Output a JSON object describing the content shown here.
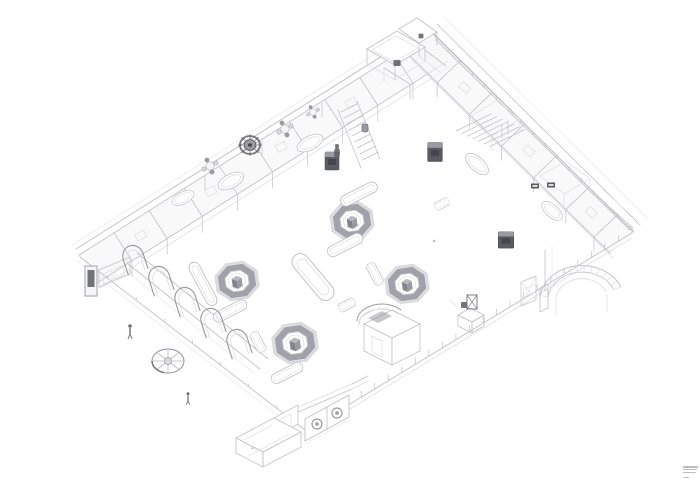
{
  "meta": {
    "kind": "isometric-architectural-line-drawing",
    "background": "#ffffff"
  },
  "canvas": {
    "width": 700,
    "height": 484
  },
  "palette": {
    "line": "#c2c2c8",
    "soft": "#dcdce1",
    "faint": "#e9e9ee",
    "strong": "#9b9ba3",
    "dark": "#5b5b63",
    "darker": "#45454d",
    "ring": "#90909a",
    "ringGlow": "#bcbcc4",
    "fillW": "#ffffff",
    "fillL": "#f5f5f7",
    "fillM": "#d9d9de",
    "cubeTop": "#b9b9c0",
    "cubeFront": "#84848c",
    "cubeSide": "#9a9aa2",
    "notebar": "#a6a6ae"
  },
  "fine_print": {
    "bars": [
      15,
      14,
      13
    ],
    "tail_bar": 6
  },
  "scene": {
    "bands": [
      {
        "x1": 79,
        "y1": 255,
        "x2": 430,
        "y2": 33,
        "ox": 18,
        "oy": 28,
        "parts": [
          0.1,
          0.2,
          0.3,
          0.4,
          0.5,
          0.6,
          0.7,
          0.8,
          0.9
        ],
        "vh": 16,
        "cab": true
      },
      {
        "x1": 432,
        "y1": 33,
        "x2": 633,
        "y2": 231,
        "ox": -23,
        "oy": 22,
        "parts": [
          0.14,
          0.3,
          0.46,
          0.62,
          0.78,
          0.92
        ],
        "vh": 14,
        "cab": true
      }
    ],
    "fences": [
      {
        "x1": 307,
        "y1": 430,
        "x2": 632,
        "y2": 233,
        "n": 24,
        "len": 6,
        "par": 5
      },
      {
        "x1": 80,
        "y1": 257,
        "x2": 305,
        "y2": 430,
        "n": 8,
        "len": 3,
        "par": 0
      },
      {
        "x1": 436,
        "y1": 40,
        "x2": 630,
        "y2": 230,
        "n": 16,
        "len": 4,
        "par": 0
      }
    ],
    "stairs": [
      {
        "x": 341,
        "y": 112,
        "sx": 2.7,
        "sy": 6.0,
        "tx": 16,
        "ty": -8,
        "n": 9
      },
      {
        "x": 456,
        "y": 131,
        "sx": 5.6,
        "sy": 2.6,
        "tx": 35,
        "ty": -17,
        "n": 7
      }
    ],
    "arcfans": [
      {
        "cx": 582,
        "cy": 300,
        "a0": 187,
        "a1": 338,
        "rings": [
          42,
          34,
          26
        ],
        "squash": 0.82,
        "n": 14
      }
    ],
    "paths": [
      {
        "d": "M76,249 L428,27",
        "c": "line",
        "w": 1
      },
      {
        "d": "M72,245 L424,23",
        "c": "faint",
        "w": 0.8
      },
      {
        "d": "M431,31 L634,232",
        "c": "line",
        "w": 1
      },
      {
        "d": "M437,24 L640,225",
        "c": "line",
        "w": 0.8
      },
      {
        "d": "M444,17 L647,218",
        "c": "faint",
        "w": 0.8
      },
      {
        "d": "M76,260 L303,435",
        "c": "faint",
        "w": 0.7
      },
      {
        "d": "M127,263 L260,369",
        "c": "line",
        "w": 0.9
      },
      {
        "d": "M137,253 L268,359",
        "c": "line",
        "w": 0.9
      },
      {
        "d": "M122,268 L255,374",
        "c": "faint",
        "w": 0.7
      },
      {
        "d": "M338,110 L361,168",
        "c": "line",
        "w": 0.8
      },
      {
        "d": "M357,101 L380,159",
        "c": "line",
        "w": 0.8
      },
      {
        "d": "M540,288 L548,284 L548,308 L540,312 Z",
        "c": "line",
        "w": 0.8
      },
      {
        "d": "M521,282 L536,276 M521,306 L536,300 M521,282 L521,306 M536,276 L536,300",
        "c": "line",
        "w": 0.7
      },
      {
        "d": "M521,290 L536,284 M521,298 L536,292 M521,282 L536,300 M536,276 L521,306",
        "c": "soft",
        "w": 0.6
      },
      {
        "d": "M556,297 L556,315 M607,294 L607,311",
        "c": "soft",
        "w": 0.7
      },
      {
        "d": "M545,250 L545,290",
        "c": "line",
        "w": 0.8
      },
      {
        "d": "M552,246 L552,286",
        "c": "faint",
        "w": 0.7
      },
      {
        "d": "M364,324 L392,310 L420,324 L392,338 Z",
        "c": "line",
        "w": 0.8,
        "f": "fillW"
      },
      {
        "d": "M364,324 L364,351 L392,365 L392,338 Z",
        "c": "line",
        "w": 0.8,
        "f": "fillW"
      },
      {
        "d": "M392,338 L392,365 L420,351 L420,324 Z",
        "c": "line",
        "w": 0.8,
        "f": "fillW"
      },
      {
        "d": "M357,321 A25,17 0 0 1 401,310",
        "c": "strong",
        "w": 1
      },
      {
        "d": "M359,325 A23,15 0 0 1 399,314",
        "c": "line",
        "w": 0.7
      },
      {
        "d": "M363,316 L381,307 M371,311 L389,307",
        "c": "soft",
        "w": 0.6
      },
      {
        "d": "M368,318 L382,311 L392,316 L378,323 Z",
        "f": "ring",
        "o": 0.5
      },
      {
        "d": "M372,336 L372,352 L382,357 L382,341 Z",
        "c": "soft",
        "w": 0.7
      },
      {
        "d": "M458,315 L470,308 L484,315 L472,322 Z",
        "c": "line",
        "w": 0.8,
        "f": "fillW"
      },
      {
        "d": "M458,315 L458,326 L472,333 L472,322 Z",
        "c": "line",
        "w": 0.8
      },
      {
        "d": "M472,322 L472,333 L484,326 L484,315 Z",
        "c": "line",
        "w": 0.8
      },
      {
        "d": "M458,308 L450,300",
        "c": "soft",
        "w": 0.7
      },
      {
        "d": "M296,413 L352,389",
        "c": "line",
        "w": 0.9
      },
      {
        "d": "M296,408 L352,384",
        "c": "soft",
        "w": 0.7
      },
      {
        "d": "M305,419 L305,441 L349,417 L349,395 Z",
        "c": "line",
        "w": 0.9,
        "f": "fillW"
      },
      {
        "d": "M327,407 L327,430",
        "c": "line",
        "w": 0.8
      },
      {
        "d": "M305,444 L349,420",
        "c": "faint",
        "w": 0.7
      },
      {
        "d": "M252,430 L252,449 L298,424 L298,405 Z",
        "c": "line",
        "w": 0.8,
        "f": "fillW"
      },
      {
        "d": "M257,432 L257,444 L272,436 L272,424 Z",
        "c": "soft",
        "w": 0.7
      },
      {
        "d": "M276,422 L276,434 L291,426 L291,414 Z",
        "c": "soft",
        "w": 0.7
      },
      {
        "d": "M352,384 L368,376",
        "c": "line",
        "w": 0.8
      },
      {
        "d": "M352,389 L368,381",
        "c": "soft",
        "w": 0.7
      },
      {
        "d": "M236,438 L274,418 L301,432 L263,452 Z",
        "c": "line",
        "w": 0.8,
        "f": "fillW"
      },
      {
        "d": "M236,438 L236,453 L263,467 L263,452 Z",
        "c": "line",
        "w": 0.8
      },
      {
        "d": "M263,452 L263,467 L301,447 L301,432 Z",
        "c": "line",
        "w": 0.8
      },
      {
        "d": "M244,440 L272,425 M248,456 L288,435",
        "c": "soft",
        "w": 0.6
      },
      {
        "d": "M367,49 L397,31 L425,47 L395,65 Z",
        "c": "line",
        "w": 0.9,
        "f": "fillW"
      },
      {
        "d": "M372,50 L396,36 L418,48 L394,62 Z",
        "c": "soft",
        "w": 0.7
      },
      {
        "d": "M367,49 L367,64 M395,65 L395,80 M425,47 L425,61",
        "c": "line",
        "w": 0.8
      },
      {
        "d": "M367,64 L395,80 M395,80 L425,61",
        "c": "soft",
        "w": 0.7
      },
      {
        "d": "M399,29 L417,18 L437,32 L419,43 Z",
        "c": "line",
        "w": 0.9,
        "f": "fillW"
      },
      {
        "d": "M419,43 L419,56 M437,32 L437,45",
        "c": "line",
        "w": 0.8
      },
      {
        "d": "M425,50 L446,66",
        "c": "line",
        "w": 0.8
      },
      {
        "d": "M419,56 L440,72",
        "c": "soft",
        "w": 0.7
      },
      {
        "d": "M384,68 L410,84 M410,84 L410,99",
        "c": "line",
        "w": 0.8
      },
      {
        "d": "M384,68 L384,82",
        "c": "soft",
        "w": 0.7
      },
      {
        "d": "M468,118 L496,101 L520,119 L492,136 Z",
        "c": "soft",
        "w": 0.7
      },
      {
        "d": "M492,136 L492,150 M520,119 L520,132",
        "c": "soft",
        "w": 0.7
      },
      {
        "d": "M502,124 L502,138 M508,120 L508,134",
        "c": "line",
        "w": 0.7
      },
      {
        "d": "M540,176 L566,161 L590,179 L564,194 Z",
        "c": "soft",
        "w": 0.7
      },
      {
        "d": "M564,194 L564,206 M590,179 L590,190",
        "c": "soft",
        "w": 0.7
      },
      {
        "d": "M597,196 L633,228",
        "c": "line",
        "w": 0.8
      },
      {
        "d": "M603,190 L639,222",
        "c": "faint",
        "w": 0.7
      },
      {
        "d": "M99,270 L130,257",
        "c": "line",
        "w": 0.8
      },
      {
        "d": "M99,270 L99,287 L130,274 L130,257",
        "c": "line",
        "w": 0.8
      },
      {
        "d": "M103,274 L103,284 L112,280 L112,270 Z",
        "c": "soft",
        "w": 0.7
      },
      {
        "d": "M115,269 L115,279 L124,275 L124,265 Z",
        "c": "soft",
        "w": 0.7
      },
      {
        "d": "M205,176 L205,190 M262,141 L262,155 M322,103 L322,117",
        "c": "line",
        "w": 0.7
      }
    ],
    "circles": [
      {
        "x": 317,
        "y": 424,
        "r": 5,
        "s": "strong",
        "w": 1.2
      },
      {
        "x": 317,
        "y": 424,
        "r": 1.8,
        "f": "strong"
      },
      {
        "x": 337,
        "y": 413,
        "r": 5,
        "s": "strong",
        "w": 1.2
      },
      {
        "x": 337,
        "y": 413,
        "r": 1.8,
        "f": "strong"
      },
      {
        "x": 434,
        "y": 241,
        "r": 1.3,
        "f": "ringGlow"
      }
    ],
    "uses": [
      {
        "s": "s-oct",
        "x": 352,
        "y": 221
      },
      {
        "s": "s-oct",
        "x": 237,
        "y": 281
      },
      {
        "s": "s-oct",
        "x": 407,
        "y": 284
      },
      {
        "s": "s-oct",
        "x": 295,
        "y": 343,
        "sx": 1.05,
        "sy": 1.05
      },
      {
        "s": "s-pillbig",
        "x": 313,
        "y": 277,
        "r": 50
      },
      {
        "s": "s-pill",
        "x": 359,
        "y": 194,
        "r": -27
      },
      {
        "s": "s-pill",
        "x": 345,
        "y": 245,
        "r": -27,
        "sx": 0.95
      },
      {
        "s": "s-pill",
        "x": 203,
        "y": 284,
        "r": 62,
        "sx": 1.2
      },
      {
        "s": "s-pill",
        "x": 230,
        "y": 311,
        "r": -27,
        "sx": 0.9,
        "sy": 0.95
      },
      {
        "s": "s-pill",
        "x": 258,
        "y": 342,
        "r": 62,
        "sx": 0.55,
        "sy": 0.85
      },
      {
        "s": "s-pill",
        "x": 287,
        "y": 373,
        "r": -27,
        "sx": 0.85,
        "sy": 0.95
      },
      {
        "s": "s-pill",
        "x": 375,
        "y": 274,
        "r": 62,
        "sx": 0.6,
        "sy": 0.85
      },
      {
        "s": "s-pill",
        "x": 442,
        "y": 204,
        "r": -27,
        "sx": 0.38,
        "sy": 0.75
      },
      {
        "s": "s-pill",
        "x": 347,
        "y": 305,
        "r": -27,
        "sx": 0.45,
        "sy": 0.8
      },
      {
        "s": "s-tub",
        "x": 231,
        "y": 181,
        "r": -27
      },
      {
        "s": "s-tub",
        "x": 310,
        "y": 143,
        "r": -27
      },
      {
        "s": "s-tub",
        "x": 183,
        "y": 198,
        "r": -27,
        "sx": 0.85,
        "sy": 0.85
      },
      {
        "s": "s-tub",
        "x": 477,
        "y": 164,
        "r": 42
      },
      {
        "s": "s-tub",
        "x": 552,
        "y": 211,
        "r": 42,
        "sx": 0.9,
        "sy": 0.9
      },
      {
        "s": "s-table",
        "x": 210,
        "y": 166
      },
      {
        "s": "s-table",
        "x": 285,
        "y": 129
      },
      {
        "s": "s-table",
        "x": 313,
        "y": 112,
        "sx": 0.8,
        "sy": 0.8
      },
      {
        "s": "s-gear",
        "x": 250,
        "y": 145
      },
      {
        "s": "s-fan",
        "x": 168,
        "y": 361
      },
      {
        "s": "s-arch",
        "x": 134,
        "y": 259,
        "r": -18,
        "sx": 1.15,
        "sy": 1.15
      },
      {
        "s": "s-arch",
        "x": 160,
        "y": 280,
        "r": -18,
        "sx": 1.15,
        "sy": 1.15
      },
      {
        "s": "s-arch",
        "x": 186,
        "y": 301,
        "r": -18,
        "sx": 1.15,
        "sy": 1.15
      },
      {
        "s": "s-arch",
        "x": 212,
        "y": 322,
        "r": -18,
        "sx": 1.15,
        "sy": 1.15
      },
      {
        "s": "s-arch",
        "x": 238,
        "y": 343,
        "r": -18,
        "sx": 1.15,
        "sy": 1.15
      },
      {
        "s": "s-box",
        "x": 332,
        "y": 161
      },
      {
        "s": "s-box",
        "x": 435,
        "y": 152,
        "sx": 1.05,
        "sy": 1.05
      },
      {
        "s": "s-box",
        "x": 506,
        "y": 240,
        "sx": 1.1,
        "sy": 0.9
      },
      {
        "s": "s-sign",
        "x": 535,
        "y": 186
      },
      {
        "s": "s-sign",
        "x": 551,
        "y": 185
      },
      {
        "s": "s-vending",
        "x": 91,
        "y": 281
      },
      {
        "s": "s-statue",
        "x": 337,
        "y": 153
      },
      {
        "s": "s-barrel",
        "x": 365,
        "y": 128
      },
      {
        "s": "s-figure",
        "x": 130,
        "y": 331
      },
      {
        "s": "s-figure",
        "x": 188,
        "y": 398,
        "sx": 0.85,
        "sy": 0.85
      },
      {
        "s": "s-turnstile",
        "x": 472,
        "y": 302
      },
      {
        "s": "s-darkblob",
        "x": 397,
        "y": 63,
        "sx": 1.2,
        "sy": 1
      },
      {
        "s": "s-darkblob",
        "x": 421,
        "y": 36,
        "sx": 0.8,
        "sy": 0.8
      },
      {
        "s": "s-darkblob",
        "x": 464,
        "y": 305
      }
    ]
  }
}
